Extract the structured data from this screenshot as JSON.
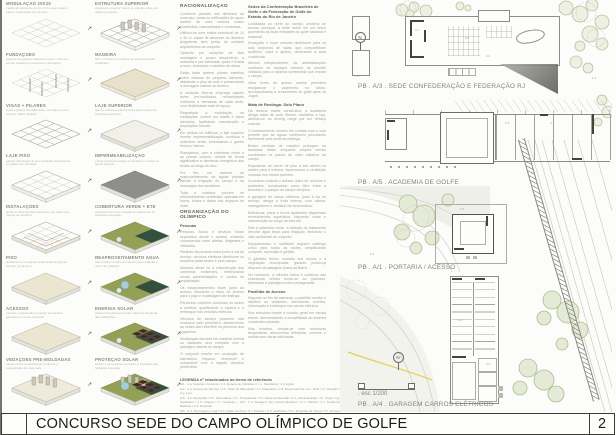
{
  "board": {
    "title": "CONCURSO SEDE DO CAMPO OLÍMPICO DE GOLFE",
    "page_number": "2"
  },
  "colors": {
    "roof_green": "#93a055",
    "roof_dark_green": "#33503f",
    "roof_gray": "#8e8f8d",
    "water_blue": "#a6cdda",
    "tree_green": "#b6c39d",
    "road_yellow": "#d9cd4d",
    "titlebar_border": "#3c3c37"
  },
  "diagrams": {
    "col_a": [
      {
        "label": "MODULAÇÃO 10x10",
        "caption": "malha de referência de 10 x 10 m que ordena toda a implantação do conjunto",
        "variant": "v-grid"
      },
      {
        "label": "FUNDAÇÕES",
        "caption": "estacas de pequeno diâmetro tocam o solo em pontos isolados e preservam a drenagem",
        "variant": "v-piles"
      },
      {
        "label": "VIGAS + PILARES",
        "caption": "vigas e pilares pré-fabricados montados a seco sobre a malha modular",
        "variant": "v-beams"
      },
      {
        "label": "LAJE PISO",
        "caption": "painéis alveolares de piso apoiados diretamente no vigamento principal",
        "variant": "v-slabwire"
      },
      {
        "label": "INSTALAÇÕES",
        "caption": "shafts e pisos técnicos distribuem as redes sem rasgos na estrutura",
        "variant": "v-inst"
      },
      {
        "label": "PISO",
        "caption": "acabamento em placas cimentícias de grande formato, junta seca",
        "variant": "v-beige"
      },
      {
        "label": "ACESSOS",
        "caption": "rampas e passarelas em todos os acessos garantem percurso universal",
        "variant": "v-access"
      },
      {
        "label": "VEDAÇÕES PRÉ-MOLDADAS",
        "caption": "painéis leves remanejáveis conforme a necessidade de cada sede",
        "variant": "v-walls"
      }
    ],
    "col_b": [
      {
        "label": "ESTRUTURA SUPERIOR",
        "caption": "vigamento superior vence os grandes vãos dos salões principais",
        "variant": "v-bwire"
      },
      {
        "label": "MADEIRA",
        "caption": "forro e brises em madeira de reflorestamento certificado",
        "variant": "v-wood"
      },
      {
        "label": "LAJE SUPERIOR",
        "caption": "laje de cobertura plana pronta para receber as camadas seguintes",
        "variant": "v-bslab"
      },
      {
        "label": "IMPERMEABILIZAÇÃO",
        "caption": "manta contínua protege a estrutura e conduz as águas pluviais",
        "variant": "v-bgray"
      },
      {
        "label": "COBERTURA VERDE + ETE",
        "caption": "cobertura viva com estação de tratamento de efluentes integrada",
        "variant": "v-bgreen"
      },
      {
        "label": "REAPROVEITAMENTO ÁGUA",
        "caption": "reservatório recolhe as chuvas para irrigação e usos não potáveis",
        "variant": "v-bwater"
      },
      {
        "label": "ENERGIA SOLAR",
        "caption": "placas fotovoltaicas suprem parte da demanda das edificações",
        "variant": "v-bsolar"
      },
      {
        "label": "PROTEÇÃO SOLAR",
        "caption": "beirais e venezianas controlam a insolação das fachadas expostas",
        "variant": "v-bshade"
      }
    ]
  },
  "col1": {
    "heading": "RACIONALIZAÇÃO",
    "paragraphs": [
      "Conforme previsto nas diretrizes do concurso, todas as edificações de apoio partem de uma mesma matriz construtiva, racionalizada e modulada.",
      "Utilizou-se uma malha estrutural de 10 x 10 m, capaz de absorver os diversos programas sem perda da unidade arquitetônica do conjunto.",
      "Optando por soluções de fácil montagem e pouco desperdício, a estrutura é pré-fabricada, içada e fixada a seco, reduzindo o canteiro de obras.",
      "Desta base partem pilares esbeltos sobre estacas de pequeno diâmetro, afastando o piso do solo e preservando a drenagem natural do terreno.",
      "A vedação interna emprega painéis leves pré-moldados, remanejáveis conforme a demanda de cada sede, com flexibilidade total de layout.",
      "Respeitada a modulação, as instalações correm em shafts e pisos elevados, facilitando manutenção e ampliações futuras.",
      "Em ambos os edifícios, a laje superior recebe impermeabilização contínua e cobertura verde, amenizando o ganho térmico interno.",
      "Planejamos, com a cobertura verde e as placas solares, reduzir de forma significativa a demanda energética das sedes ao longo do ano.",
      "Por fim, um sistema de reaproveitamento de águas pluviais atende à irrigação do campo e às descargas dos sanitários.",
      "Toda a madeira provém de reflorestamento certificado, aplicada em forros, brises e decks dos espaços de estar."
    ],
    "section2_heading": "ORGANIZAÇÃO DO OLÍMPICO",
    "section2_subheading": "Pessoas",
    "section2_paragraphs": [
      "Pessoas, fluxos e serviços foram separados desde o acesso, evitando cruzamentos entre atletas, dirigentes e visitantes.",
      "Partindo da portaria única junto à via de serviço, veículos elétricos distribuem os usuários pelas sedes e pelo campo.",
      "Adotada ainda foi a manutenção dos caminhos existentes, minimizando novas pavimentações e custos de implantação.",
      "Os estacionamentos ficam junto ao acesso, liberando o miolo do terreno para o jogo e a paisagem da restinga.",
      "Percursos cobertos conectam as sedes à sombra, qualificando a espera e o embarque nos veículos elétricos.",
      "Veículos de serviço possuem rota exclusiva pelo perímetro, abastecendo as sedes sem interferir no percurso dos jogadores.",
      "Sinalização discreta em madeira orienta os visitantes sem competir com a paisagem aberta do campo.",
      "O conjunto resulta em ocupação de baixíssimo impacto, reversível e compatível com o legado olímpico pretendido."
    ]
  },
  "col2": {
    "heading": "Sedes da Confederação Brasileira de Golfe e da Federação de Golfe do Estado do Rio de Janeiro",
    "paragraphs_a": [
      "Localizada ao norte do campo, próxima ao acesso principal, a sede reúne em um único pavimento as duas entidades do golfe nacional e estadual.",
      "Recepção e foyer comuns distribuem para os dois conjuntos de salas, que compartilham auditório, copa e apoios, otimizando a área construída.",
      "Mesmo independentes, as administrações usufruem de espaços comuns de reunião voltados para a varanda sombreada que encara o campo.",
      "Vãos livres de quinze metros permitem reorganizar o pavimento no futuro, acompanhando o crescimento do golfe após os Jogos."
    ],
    "subheading_a": "Mata de Restinga: Solo Plano",
    "paragraphs_b": [
      "Da mesma matriz construtiva, a academia abriga salas de aula, fitness, vestiários e loja, abrindo-se ao driving range por um terraço coberto.",
      "O embasamento mínimo em contato com o solo permite que as águas continuem percolando livremente pela areia da restinga.",
      "Brises verticais de madeira protegem as fachadas oeste, enquanto amplos beirais sombreiam os panos de vidro voltados ao campo.",
      "Esquadrias de correr de piso a teto abrem os salões para o exterior, favorecendo a ventilação cruzada nos meses quentes.",
      "A portaria controla o acesso único de veículos e pedestres, funcionando como filtro entre a avenida e o parque do campo olímpico.",
      "A garagem de carros elétricos, junto à via de serviço, abriga a frota interna, com oficina, carregadores e vestiário de funcionários.",
      "Estruturas, pisos e forros aparentes dispensam revestimentos supérfluos, baixando custo e manutenção ao longo da vida útil.",
      "Sob a cobertura verde, a estação de tratamento devolve água limpa para irrigação, fechando o ciclo ambiental do conjunto.",
      "Equipamentos e mobiliário seguem catálogo único para todas as sedes, simplificando compras, reposição e gestão.",
      "O gabarito térreo, somado aos recuos e à vegetação recomposta, garante presença discreta na paisagem plana da Barra.",
      "No horizonte, a silhueta baixa e contínua das coberturas verdes funde-se ao gramado, afirmando a paisagem como protagonista."
    ],
    "subheading_b": "Pavilhão de Acesso",
    "paragraphs_c": [
      "Disposto no fim da alameda, o pavilhão recebe e distribui os visitantes, oferecendo sombra, informação e embarque nos carros elétricos.",
      "Sua estrutura repete o módulo geral em escala menor, demonstrando a versatilidade do sistema construtivo adotado.",
      "Nos eventos, amplia-se com estruturas temporárias, absorvendo bilheteria, controle e revista sem obras adicionais."
    ]
  },
  "legend": {
    "title": "LEGENDA nº relacionados ao termo de referência",
    "rows": [
      "A/1 . 1 a. Guarita e Controle / 1 b. Espera de Visitantes / 1 c. Sanitários / 1 d. Apoio",
      "A/2 . 2 a. Acesso de Serviço / 2 b. Pátio de Manobras / 2 c. Depósitos / 2 d. Reservatórios / 2 e. ETE / 2 f. Gerador / 2 g. Lixo",
      "A/3 . 3 a. Recepção / 3 b. Secretarias / 3 c. Presidência / 3 d. Salas de Reunião / 3 e. Administração / 3 f. Copa / 3 g. Sanitários / 3 h. Arquivo / 3 i. Varanda — A/4 . 4 a. Garagem dos Carros Elétricos / 4 b. Oficina / 4 c. Carga de Baterias / 4 d. Depósito",
      "A/5 . 5 a. Recepção e Loja / 5 b. Salas de Aula / 5 c. Fitness / 5 d. Vestiários / 5 e. Depósito de Tacos / 5 f. Terraço Coberto / 5 g. Apoio do Driving Range"
    ]
  },
  "plans": {
    "north_label": "N",
    "a3": {
      "label": "PB . A/3 . SEDE CONFEDERAÇÃO E FEDERAÇÃO RJ"
    },
    "a5": {
      "label": "PB . A/5 . ACADEMIA DE GOLFE"
    },
    "a1": {
      "label": "PB . A/1 . PORTARIA / ACESSO"
    },
    "a4": {
      "label": "PB . A/4 . GARAGEM CARROS ELÉTRICOS",
      "scale": ". esc 1/200"
    },
    "dims": [
      {
        "t": "3.1",
        "x": 75,
        "y": 28
      },
      {
        "t": "5.5",
        "x": 125,
        "y": 36
      },
      {
        "t": "3.3",
        "x": 146,
        "y": 54
      },
      {
        "t": "1.4",
        "x": 252,
        "y": 76
      },
      {
        "t": "5.4",
        "x": 165,
        "y": 121
      },
      {
        "t": "4.1",
        "x": 210,
        "y": 121
      },
      {
        "t": "1.6",
        "x": 120,
        "y": 207
      },
      {
        "t": "1.4",
        "x": 30,
        "y": 252
      },
      {
        "t": "4.1",
        "x": 118,
        "y": 318
      },
      {
        "t": "4.4",
        "x": 146,
        "y": 362
      }
    ]
  }
}
